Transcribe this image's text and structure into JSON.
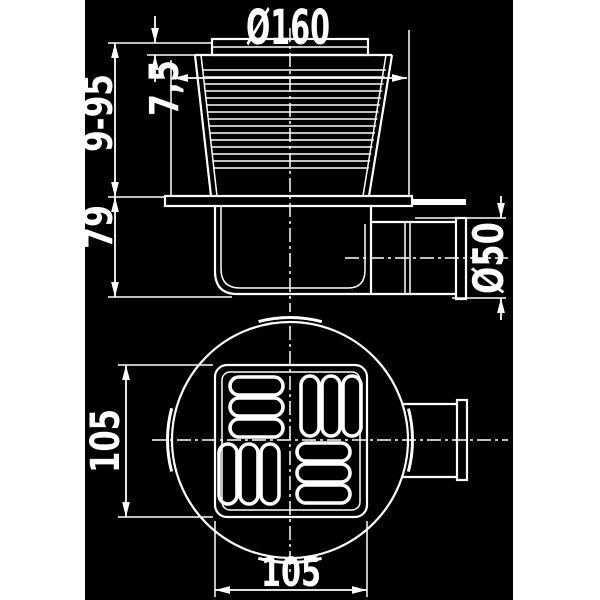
{
  "drawing": {
    "type": "technical-drawing-floor-drain",
    "colors": {
      "margin_background": "#ffffff",
      "drawing_background": "#000000",
      "line_color": "#ffffff"
    },
    "side_view": {
      "collar_diameter": "Ø160",
      "grate_edge_height": "7,5",
      "adjustable_height_range": "9-95",
      "body_height": "79",
      "outlet_diameter": "Ø50"
    },
    "top_view": {
      "grate_width": "105",
      "grate_height": "105"
    }
  }
}
